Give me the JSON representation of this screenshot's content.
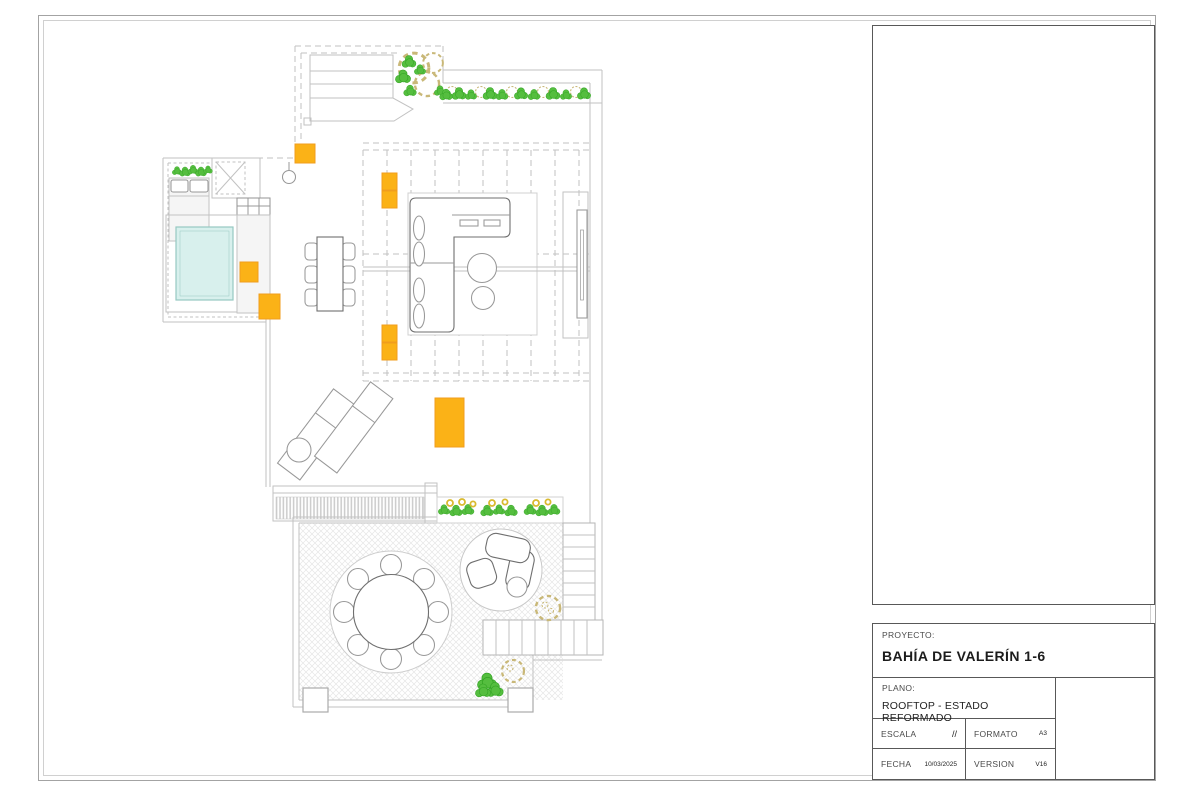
{
  "title_block": {
    "project_label": "PROYECTO:",
    "project_name": "BAHÍA DE VALERÍN 1-6",
    "plan_label": "PLANO:",
    "plan_name": "ROOFTOP - ESTADO REFORMADO",
    "scale_label": "ESCALA",
    "scale_value": "//",
    "format_label": "FORMATO",
    "format_value": "A3",
    "date_label": "FECHA",
    "date_value": "10/03/2025",
    "version_label": "VERSION",
    "version_value": "V16"
  },
  "colors": {
    "accent_orange": "#FBB217",
    "accent_orange_border": "#F09D1E",
    "pool_fill": "#D8F0ED",
    "pool_border": "#96C9C2",
    "plant_green": "#55BE3F",
    "plant_dark_green": "#35A526",
    "planter_tan": "#C9B878",
    "flower_yellow": "#D9BA2F",
    "line_light": "#C2C2C2",
    "line_mid": "#989898",
    "line_dark": "#6F6F6F",
    "hatch_color": "#E6E6E6"
  },
  "plan": {
    "features": [
      "stair-bulkhead",
      "corner-planter",
      "north-plant-row",
      "bedroom-wing",
      "daybed",
      "skylight",
      "outdoor-kitchen",
      "jacuzzi",
      "dining-table-6",
      "pergola-slats",
      "l-shaped-sofa",
      "coffee-tables",
      "tv-wall",
      "sun-loungers",
      "louver-deck-strip",
      "south-plant-strip",
      "lower-terrace",
      "round-dining-set-8",
      "circular-lounge",
      "stairs",
      "terrace-plants",
      "accent-posts"
    ]
  }
}
